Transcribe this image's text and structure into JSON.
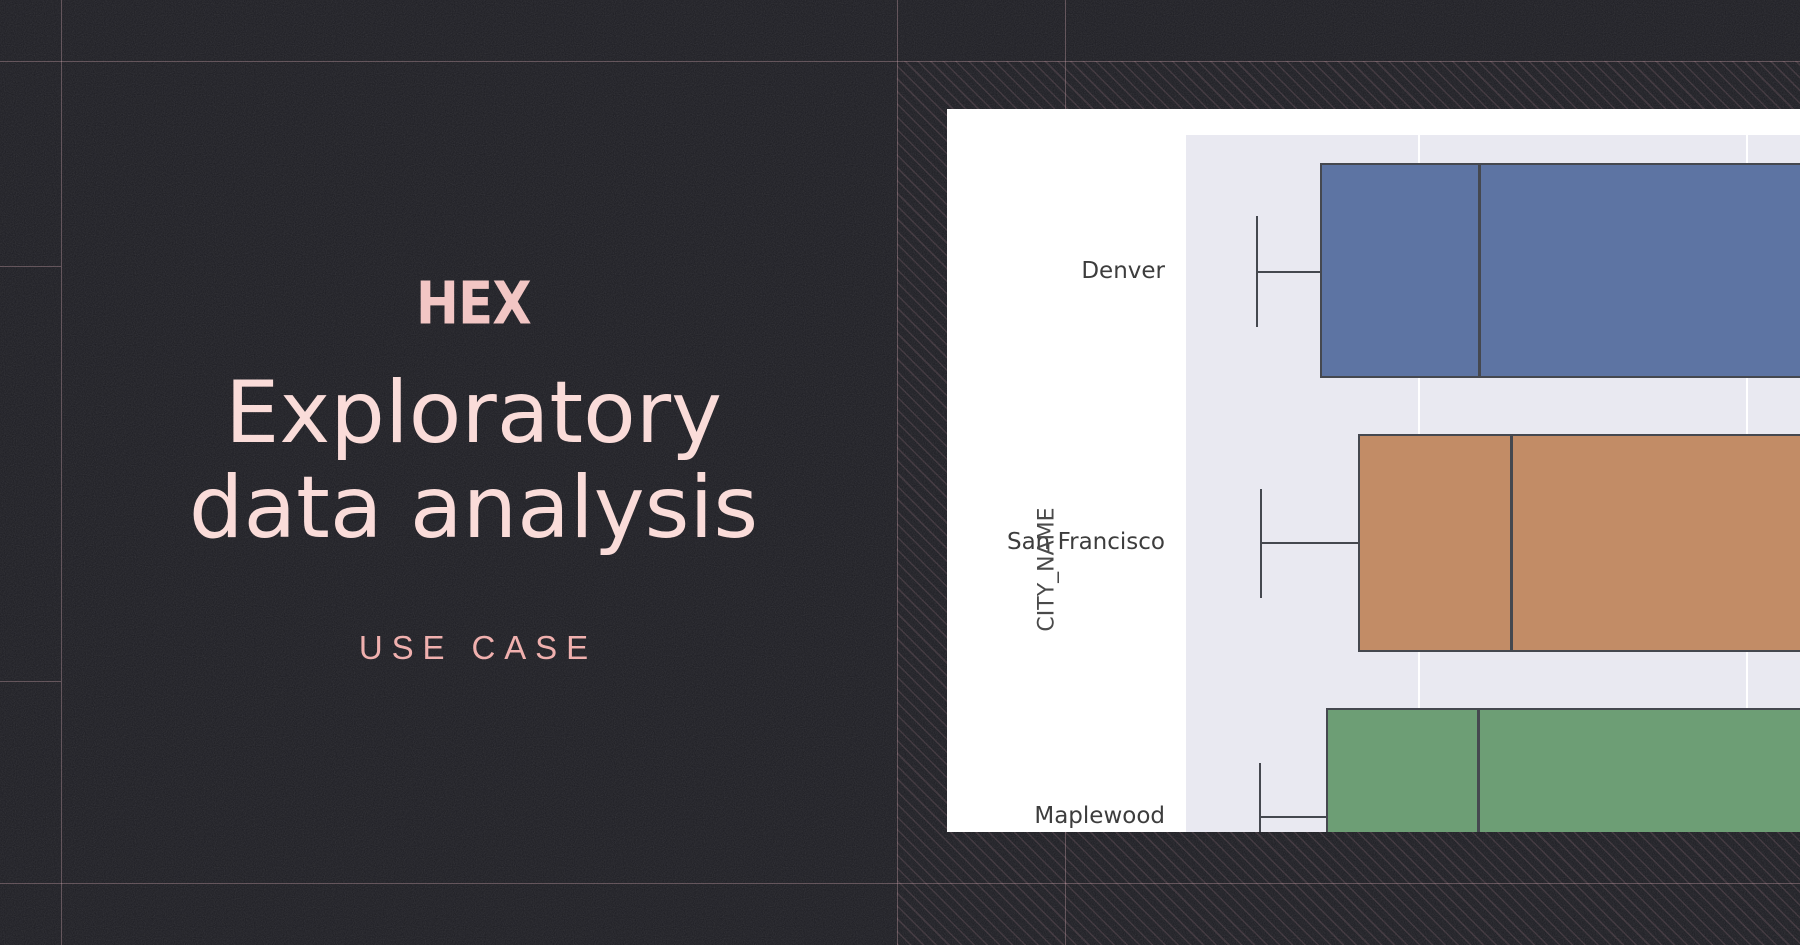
{
  "page": {
    "background_color": "#1c1c22",
    "guide_line_color": "rgba(226,178,189,0.33)",
    "hatch_color": "rgba(232,170,185,0.14)"
  },
  "left_panel": {
    "logo_text": "HEX",
    "logo_color": "#f2c6c4",
    "title_line1": "Exploratory",
    "title_line2": "data analysis",
    "title_color": "#fadcd9",
    "subtitle": "USE CASE",
    "subtitle_color": "#f0b0ae"
  },
  "chart_card": {
    "background": "#ffffff",
    "plot_background": "#e9e9f1",
    "gridline_color": "#ffffff",
    "box_edge_color": "#45484f",
    "label_color": "#3d3d3d"
  },
  "chart_data": {
    "type": "box",
    "orientation": "horizontal",
    "title": "",
    "xlabel": "",
    "ylabel": "CITY_NAME",
    "categories": [
      "Denver",
      "San Francisco",
      "Maplewood"
    ],
    "cropped": "figure is cut off at the right and bottom edges; numeric x-axis not visible",
    "units": "fraction of visible plot width (x-axis scale not shown in screenshot)",
    "series": [
      {
        "name": "Denver",
        "color": "#5d74a3",
        "whisker_low": 0.114,
        "q1": 0.218,
        "median": 0.476,
        "q3": null,
        "whisker_high": null
      },
      {
        "name": "San Francisco",
        "color": "#c28c66",
        "whisker_low": 0.121,
        "q1": 0.28,
        "median": 0.528,
        "q3": null,
        "whisker_high": null
      },
      {
        "name": "Maplewood",
        "color": "#6d9e75",
        "whisker_low": 0.119,
        "q1": 0.228,
        "median": 0.474,
        "q3": null,
        "whisker_high": null
      }
    ],
    "legend": null,
    "grid": "vertical white gridlines on light-gray panel (seaborn darkgrid style)"
  }
}
